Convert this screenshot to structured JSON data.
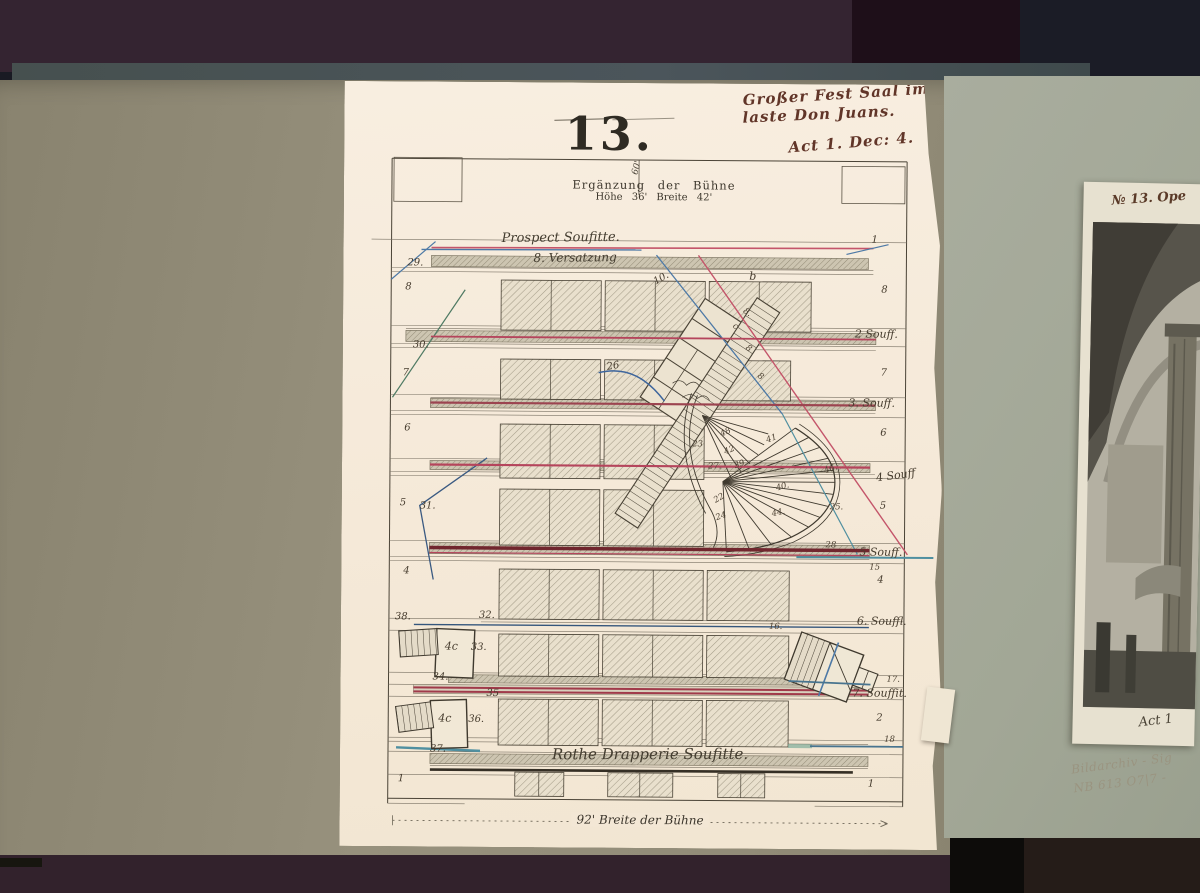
{
  "paper": {
    "header": {
      "line1": "Großer Fest Saal im Pa",
      "line2": "laste Don Juans.",
      "line3": "Act 1. Dec: 4."
    },
    "plate_number": "13.",
    "title": "Ergänzung der Bühne",
    "subtitle": "Höhe 36'  Breite 42'",
    "depth_label": "60'",
    "prospect_label": "Prospect Soufitte.",
    "versatzung_label": "8. Versatzung",
    "drapery_label": "Rothe Drapperie Soufitte.",
    "width_label": "92' Breite der Bühne",
    "annotations": [
      {
        "text": "29.",
        "x": 64,
        "y": 176
      },
      {
        "text": "8",
        "x": 62,
        "y": 200
      },
      {
        "text": "30.",
        "x": 70,
        "y": 258
      },
      {
        "text": "7",
        "x": 60,
        "y": 286
      },
      {
        "text": "6",
        "x": 62,
        "y": 341
      },
      {
        "text": "5",
        "x": 58,
        "y": 416
      },
      {
        "text": "31.",
        "x": 78,
        "y": 419
      },
      {
        "text": "4",
        "x": 62,
        "y": 484
      },
      {
        "text": "38.",
        "x": 54,
        "y": 530
      },
      {
        "text": "32.",
        "x": 138,
        "y": 528
      },
      {
        "text": "33.",
        "x": 130,
        "y": 560
      },
      {
        "text": "34.",
        "x": 92,
        "y": 590
      },
      {
        "text": "35",
        "x": 146,
        "y": 606
      },
      {
        "text": "36.",
        "x": 128,
        "y": 632
      },
      {
        "text": "37.",
        "x": 90,
        "y": 662
      },
      {
        "text": "1",
        "x": 58,
        "y": 692
      },
      {
        "text": "1",
        "x": 528,
        "y": 150
      },
      {
        "text": "8",
        "x": 538,
        "y": 200
      },
      {
        "text": "2 Souff.",
        "x": 512,
        "y": 243,
        "cls": "script2"
      },
      {
        "text": "7",
        "x": 538,
        "y": 283
      },
      {
        "text": "3. Souff.",
        "x": 506,
        "y": 312,
        "cls": "script2"
      },
      {
        "text": "6",
        "x": 538,
        "y": 343
      },
      {
        "text": "4 Souff",
        "x": 534,
        "y": 384,
        "cls": "script2",
        "rot": -8
      },
      {
        "text": "5",
        "x": 538,
        "y": 416
      },
      {
        "text": "28",
        "x": 484,
        "y": 456,
        "cls": "tiny"
      },
      {
        "text": "5 Souff.",
        "x": 518,
        "y": 461,
        "cls": "script2"
      },
      {
        "text": "15",
        "x": 528,
        "y": 478,
        "cls": "tiny"
      },
      {
        "text": "4",
        "x": 536,
        "y": 490
      },
      {
        "text": "16.",
        "x": 428,
        "y": 538,
        "cls": "tiny"
      },
      {
        "text": "6. Souffl.",
        "x": 516,
        "y": 530,
        "cls": "script2"
      },
      {
        "text": "17.",
        "x": 546,
        "y": 590,
        "cls": "tiny"
      },
      {
        "text": "7. Souffit.",
        "x": 512,
        "y": 602,
        "cls": "script2"
      },
      {
        "text": "2",
        "x": 536,
        "y": 628
      },
      {
        "text": "18",
        "x": 544,
        "y": 650,
        "cls": "tiny"
      },
      {
        "text": "1",
        "x": 528,
        "y": 694
      },
      {
        "text": "10.",
        "x": 310,
        "y": 190,
        "rot": -30
      },
      {
        "text": "b",
        "x": 406,
        "y": 186,
        "cls": "script2"
      },
      {
        "text": "8.",
        "x": 400,
        "y": 224,
        "cls": "tiny",
        "rot": 35
      },
      {
        "text": "c",
        "x": 390,
        "y": 238,
        "cls": "tiny",
        "rot": 35
      },
      {
        "text": "8",
        "x": 403,
        "y": 260,
        "cls": "tiny",
        "rot": 35
      },
      {
        "text": "8",
        "x": 415,
        "y": 288,
        "cls": "tiny",
        "rot": 35
      },
      {
        "text": "26",
        "x": 264,
        "y": 278,
        "rot": -10
      },
      {
        "text": "23",
        "x": 350,
        "y": 356,
        "cls": "tiny"
      },
      {
        "text": "48",
        "x": 378,
        "y": 344,
        "cls": "tiny",
        "rot": -25
      },
      {
        "text": "42",
        "x": 382,
        "y": 362,
        "cls": "tiny",
        "rot": -25
      },
      {
        "text": "39",
        "x": 392,
        "y": 376,
        "cls": "tiny",
        "rot": -20
      },
      {
        "text": "41",
        "x": 424,
        "y": 350,
        "cls": "tiny",
        "rot": -20
      },
      {
        "text": "27.",
        "x": 366,
        "y": 378,
        "cls": "tiny"
      },
      {
        "text": "46.",
        "x": 482,
        "y": 380,
        "cls": "tiny",
        "rot": -20
      },
      {
        "text": "40.",
        "x": 434,
        "y": 398,
        "cls": "tiny",
        "rot": -15
      },
      {
        "text": "44.",
        "x": 430,
        "y": 424,
        "cls": "tiny",
        "rot": -12
      },
      {
        "text": "22",
        "x": 372,
        "y": 410,
        "cls": "tiny",
        "rot": -30
      },
      {
        "text": "24",
        "x": 374,
        "y": 428,
        "cls": "tiny",
        "rot": -20
      },
      {
        "text": "25.",
        "x": 488,
        "y": 418,
        "cls": "tiny"
      },
      {
        "text": "4c",
        "x": 104,
        "y": 558,
        "cls": "script2"
      },
      {
        "text": "4c",
        "x": 98,
        "y": 630,
        "cls": "script2"
      }
    ]
  },
  "artwork": {
    "caption_top": "№ 13. Ope",
    "caption_bottom": "Act 1"
  },
  "pencil_note": {
    "line1": "Bildarchiv - Sig",
    "line2": "NB 613 O7|7 -"
  },
  "colors": {
    "red_ink": "#c4556a",
    "dark_red": "#71262e",
    "blue_ink": "#4d79a6",
    "teal_ink": "#4f8fa0",
    "green_ink": "#4e7a63",
    "paper": "#f5e9d8",
    "page_left": "#938d79",
    "page_right": "#a4a899",
    "leather_maroon": "#342431",
    "leather_black": "#1b1c26"
  }
}
